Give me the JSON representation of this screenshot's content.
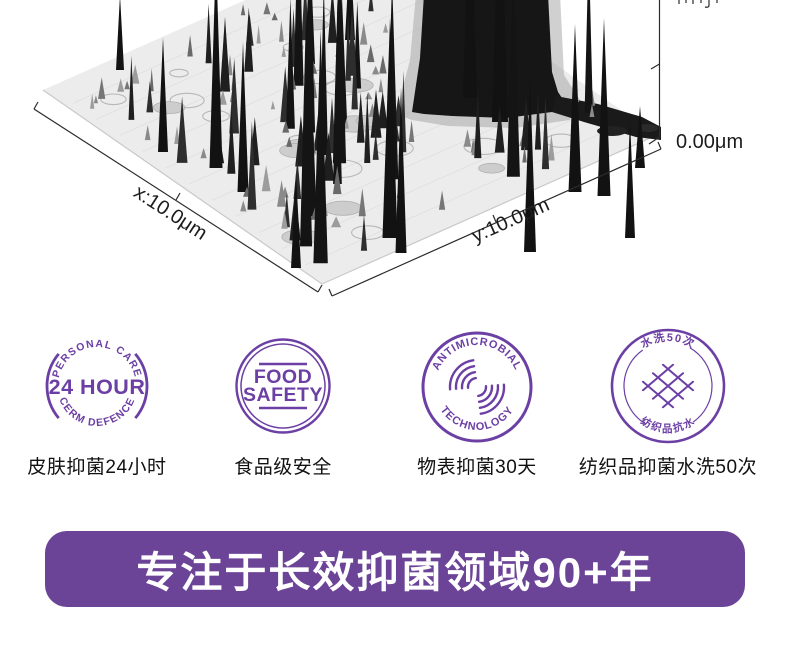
{
  "afm_plot": {
    "x_axis_label": "x:10.0μm",
    "y_axis_label": "y:10.0μm",
    "z_axis_label": "0.00μm"
  },
  "badges": [
    {
      "name": "skin-24-hour",
      "arc_top": "PERSONAL CARE",
      "center": "24 HOUR",
      "arc_bottom": "CERM DEFENCE",
      "caption": "皮肤抑菌24小时"
    },
    {
      "name": "food-safety",
      "line1": "FOOD",
      "line2": "SAFETY",
      "caption": "食品级安全"
    },
    {
      "name": "antimicrobial-technology",
      "arc_top": "ANTIMICROBIAL",
      "arc_bottom": "TECHNOLOGY",
      "caption": "物表抑菌30天"
    },
    {
      "name": "textile-wash-50",
      "arc_top": "水洗50次",
      "arc_bottom": "纺织品抗水",
      "caption": "纺织品抑菌水洗50次"
    }
  ],
  "banner": {
    "text": "专注于长效抑菌领域90+年"
  },
  "colors": {
    "brand_purple": "#6B4397",
    "badge_purple": "#6C3FA4",
    "caption_text": "#111111"
  }
}
